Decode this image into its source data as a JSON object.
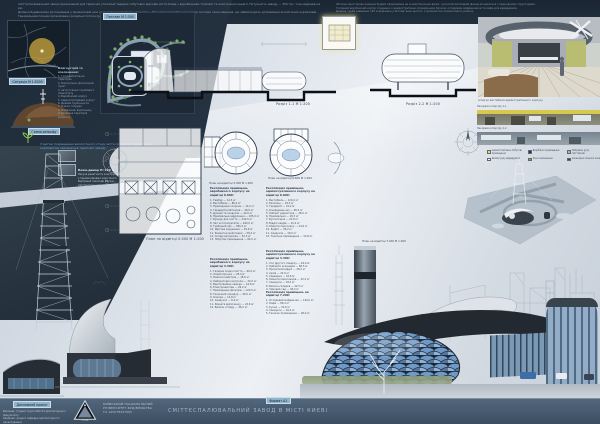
{
  "header_notes": {
    "block1_lines": [
      "Сміттєспалювальний завод призначений для термічної утилізації твердих побутових відходів міста Києва з виробленням теплової та електричної енергії. Потужність заводу — 350 тис. тонн відходів на рік.",
      "Ділянка будівництва розташована у промисловій зоні на перетині магістральних вулиць. Проектом передбачено сучасні системи газоочищення, що забезпечують дотримання екологічних нормативів.",
      "Генеральним планом організовано роздільні потоки руху сміттєвозів, службового транспорту та відвідувачів."
    ],
    "block2_lines": [
      "Об'ємно-просторове рішення будівлі сформоване на основі біонічних форм: лускатий металевий фасад асоціюється з природними структурами.",
      "Головний виробничий корпус поєднано з адміністративно-громадським блоком, оглядовим майданчиком та кафе для відвідувачів.",
      "Димова труба заввишки 120 м вирішена у вигляді вежі-щогли і є домінантою промислового району."
    ]
  },
  "site": {
    "situation_label": "Ситуація М 1:5000",
    "relief_label": "Схема рельєфу",
    "genplan_label": "Генплан М 1:500",
    "landscaping_title": "Благоустрій та озеленення:",
    "landscaping_items": [
      "1. Головний в'їзд на територію",
      "2. Контрольно-пропускний пункт",
      "3. Автостоянка службового транспорту",
      "4. Виробничий корпус",
      "5. Адміністративний корпус",
      "6. Димова труба-щогла",
      "7. Очисні споруди",
      "8. Майданчик відпочинку",
      "9. Резервна територія розвитку"
    ],
    "eco_note": "З метою покращення екологічного стану міста проектом передбачено комплексне озеленення території заводу."
  },
  "sections": {
    "s1_caption": "Розріз 1-1 М 1:200",
    "s2_caption": "Розріз 2-2 М 1:200"
  },
  "plans": {
    "a_caption": "План на відмітці 0.000 М 1:200",
    "b_caption": "План на відмітці 3.300 М 1:200",
    "c_caption": "План на відмітці 6.600 М 1:200",
    "d_caption": "План на відмітці 7.200 М 1:200"
  },
  "schedules": [
    {
      "title": "Експлікація приміщень виробничого корпусу на відмітці 0.000:",
      "items": [
        "1. Тамбур — 12,5 м²",
        "2. Вестибюль — 86,4 м²",
        "3. Приміщення охорони — 14,2 м²",
        "4. Гардероб робітників — 36,8 м²",
        "5. Душові та санвузли — 42,6 м²",
        "6. Приймальне відділення — 185,0 м²",
        "7. Бункер для сміття — 240,5 м²",
        "8. Зал котлоагрегатів — 620,0 м²",
        "9. Турбінний зал — 380,2 м²",
        "10. Щитова керування — 45,6 м²",
        "11. Ремонтна майстерня — 58,4 м²",
        "12. Склад матеріалів — 52,3 м²",
        "13. Побутові приміщення — 64,0 м²"
      ]
    },
    {
      "title": "Експлікація приміщень виробничого корпусу на відмітці 3.300:",
      "items": [
        "1. Галерея подачі сміття — 96,0 м²",
        "2. Операторська — 28,4 м²",
        "3. Кімната майстрів — 18,6 м²",
        "4. Лабораторія контролю — 32,0 м²",
        "5. Вентиляційна камера — 44,8 м²",
        "6. Електрощитова — 26,2 м²",
        "7. Приміщення фільтрів — 120,5 м²",
        "8. Технічний коридор — 48,0 м²",
        "9. Комора — 12,8 м²",
        "10. Санвузол — 8,4 м²",
        "11. Кімната відпочинку — 22,6 м²",
        "12. Балкон огляду — 36,0 м²"
      ]
    },
    {
      "title": "Експлікація приміщень адміністративного корпусу на відмітці 0.000:",
      "items": [
        "1. Вестибюль — 120,0 м²",
        "2. Ресепшн — 18,5 м²",
        "3. Гардероб — 24,2 м²",
        "4. Конференц-зал — 96,4 м²",
        "5. Кабінет директора — 28,0 м²",
        "6. Приймальня — 16,5 м²",
        "7. Бухгалтерія — 22,8 м²",
        "8. Відділ кадрів — 20,4 м²",
        "9. Кімната персоналу — 24,6 м²",
        "10. Буфет — 36,2 м²",
        "11. Санвузли — 18,0 м²",
        "12. Технічне приміщення — 14,8 м²"
      ]
    },
    {
      "title": "Експлікація приміщень адміністративного корпусу на відмітці 3.300:",
      "items": [
        "1. Хол другого поверху — 64,0 м²",
        "2. Кабінети інженерів — 86,5 м²",
        "3. Проектний відділ — 48,2 м²",
        "4. Архів — 22,6 м²",
        "5. Серверна — 16,8 м²",
        "6. Кімната переговорів — 32,4 м²",
        "7. Санвузли — 18,0 м²",
        "8. Балкон-галерея — 42,5 м²",
        "9. Зимовий сад — 56,0 м²"
      ]
    },
    {
      "title": "Експлікація приміщень на відмітці 7.200:",
      "items": [
        "1. Оглядовий майданчик — 120,0 м²",
        "2. Кафе — 86,4 м²",
        "3. Кухня — 32,6 м²",
        "4. Санвузли — 16,2 м²",
        "5. Технічні приміщення — 28,0 м²"
      ]
    }
  ],
  "tower_note": {
    "title": "Вежа-димар H=120 м",
    "lines": [
      "Несуча решітчаста конструкція",
      "з трьома рівнями жорсткості.",
      "Внутрішні газоходи Ø2,4 м.",
      "Архітектурне підсвічування",
      "виконує роль міського маяка.",
      "Оглядовий рівень +86.000."
    ]
  },
  "interiors": {
    "main_caption": "Інтер'єр вестибюля адміністративного корпусу",
    "pan1_label": "Панорама інтер'єру 1-1",
    "pan2_label": "Панорама інтер'єру 2-2"
  },
  "legend": {
    "items": [
      {
        "color": "#e3df56",
        "label": "Адміністративно-побутові приміщення"
      },
      {
        "color": "#2c3238",
        "label": "Виробничі приміщення"
      },
      {
        "color": "#aeb5bd",
        "label": "Напрямок руху сміттєвозів"
      },
      {
        "color": "#f2f4f6",
        "label": "Шляхи руху відвідувачів"
      },
      {
        "color": "#9d9b44",
        "label": "Зони озеленення"
      },
      {
        "color": "#3a4047",
        "label": "Інженерно-технічні зони"
      }
    ]
  },
  "footer": {
    "stamp": "Дипломний проект",
    "sheet_label": "Формат А1",
    "credits_lines": [
      "Виконав: студент групи АБС-51 архітектурного факультету",
      "Керівник: доцент кафедри архітектурного проектування"
    ],
    "university_lines": [
      "КИЇВСЬКИЙ НАЦІОНАЛЬНИЙ",
      "УНІВЕРСИТЕТ БУДІВНИЦТВА",
      "ТА АРХІТЕКТУРИ"
    ],
    "logo_caption": "КНУБА",
    "title": "СМІТТЄСПАЛЮВАЛЬНИЙ ЗАВОД В МІСТІ КИЄВІ"
  },
  "colors": {
    "panel_dark": "#1f2b38",
    "footer_bar": "#46586c",
    "accent_blue": "#6ea6d6",
    "genplan_green": "#7db061",
    "site_marker_yellow": "#c6a33c",
    "facade_scale_blue": "#7ea6d2"
  }
}
